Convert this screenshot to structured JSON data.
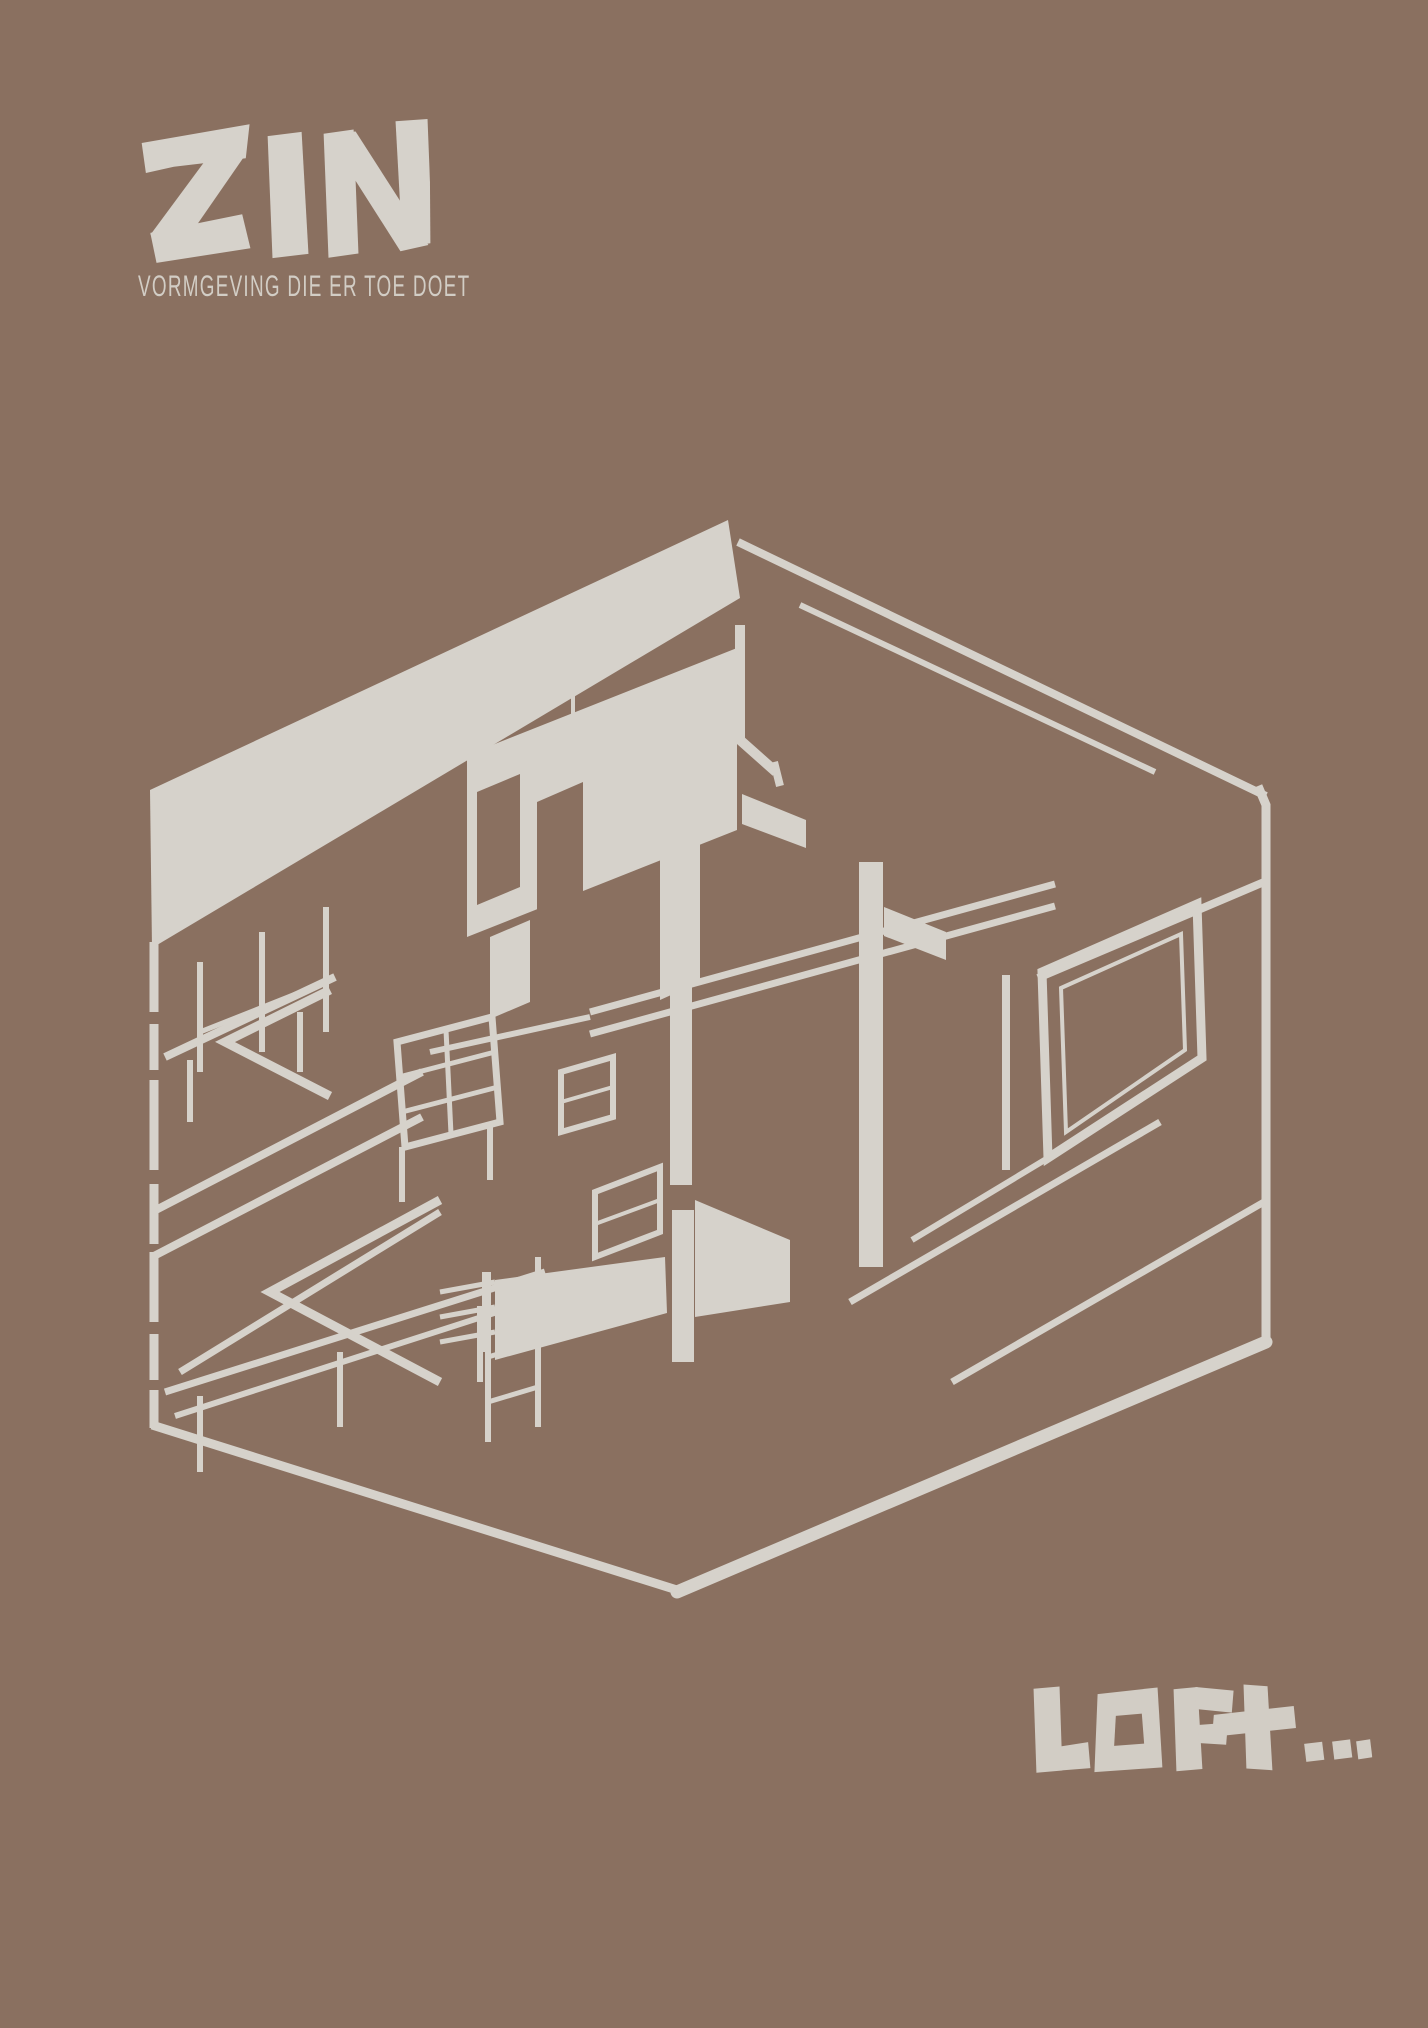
{
  "theme": {
    "bg": "#8a7060",
    "ink": "#d6d2cb",
    "ink-soft": "#d2cdc5"
  },
  "brand": {
    "logo_text": "ZIN",
    "tagline": "VORMGEVING DIE ER TOE DOET"
  },
  "artwork": {
    "alt": "Hand-drawn isometric cutaway sketch of a loft interior: open box with thick roof band, interior wall with window openings, tall columns, mezzanine railings, stairs, shelving and a large window wall on the right"
  },
  "footer": {
    "word": "LOFt",
    "ellipsis": "...",
    "full_text": "LOFt..."
  }
}
